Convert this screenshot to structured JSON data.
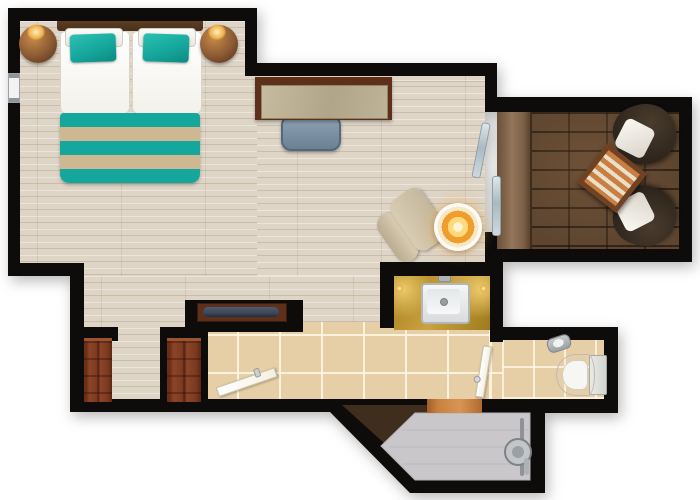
{
  "meta": {
    "view": "floor-plan-top-down",
    "text_visible_on_screen": "none"
  },
  "colors": {
    "background": "#ffffff",
    "wall": "#0d0c0b",
    "wood_floor_light": "#ded5c7",
    "tile_floor": "#e6cfa7",
    "deck_wood": "#5d4530",
    "accent_teal": "#16a79c",
    "stripe_tan": "#cdb892",
    "headboard_brown": "#4a2f1b",
    "nightstand_copper": "#8a5a33",
    "lamp_gold": "#f0b04a",
    "desk_frame": "#5e3019",
    "desk_marble": "#bdb296",
    "chair_blue": "#7e93a6",
    "armchair_beige": "#d3c7ae",
    "lamp_amber": "#f19d2e",
    "patio_chair_dark": "#2d241b",
    "patio_cushion": "#f2efe8",
    "table_stripe_orange": "#c97e42",
    "table_stripe_cream": "#eadfc9",
    "table_frame": "#6f4223",
    "counter_gold": "#b98f2c",
    "sink_white": "#eef0f0",
    "closet_door": "#7c3a20",
    "console_navy": "#3c4859",
    "door_leaf": "#f4f0e2",
    "threshold_orange": "#c8813f",
    "shower_floor": "#c9c7ca",
    "chrome": "#a9adb0",
    "window_white": "#f2f2f2"
  },
  "areas": {
    "bedroom": {
      "items": [
        "double-bed",
        "headboard",
        "white-pillows",
        "teal-accent-pillows",
        "striped-foot-runner",
        "nightstand-left",
        "nightstand-right",
        "bedside-lamp-left",
        "bedside-lamp-right",
        "window",
        "desk",
        "desk-chair"
      ]
    },
    "living_area": {
      "items": [
        "lounge-chair",
        "illuminated-round-table",
        "tv-console",
        "sliding-glass-door"
      ]
    },
    "balcony": {
      "items": [
        "wood-decking",
        "patio-chair-top",
        "patio-chair-bottom",
        "striped-patio-table"
      ]
    },
    "entry_hall": {
      "items": [
        "closet-left",
        "closet-right",
        "entry-door",
        "tiled-floor"
      ]
    },
    "vanity_nook": {
      "items": [
        "gold-counter",
        "sink",
        "faucet",
        "counter-lights"
      ]
    },
    "toilet_room": {
      "items": [
        "toilet",
        "toilet-paper-holder",
        "toilet-door"
      ]
    },
    "shower_room": {
      "items": [
        "shower-floor",
        "shower-fixture",
        "entry-threshold"
      ]
    }
  }
}
